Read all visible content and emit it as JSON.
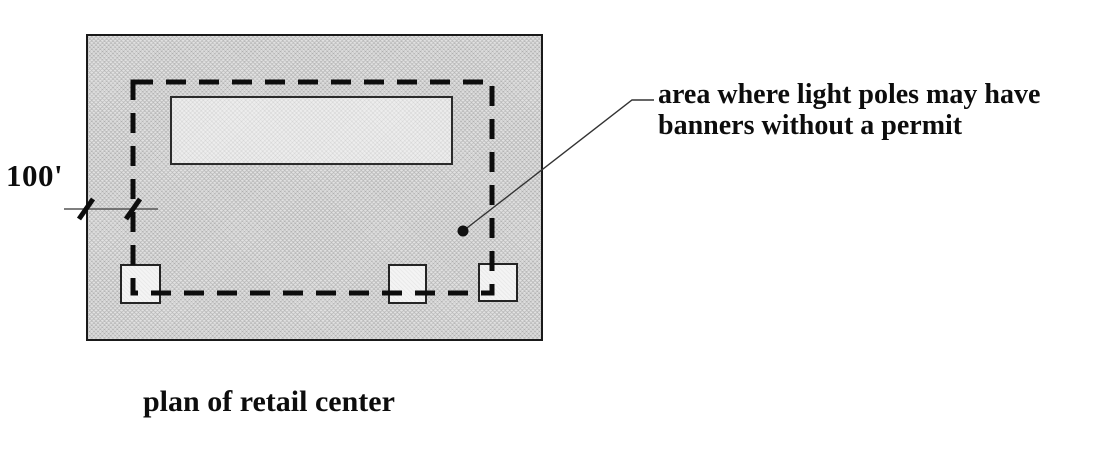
{
  "figure": {
    "caption": "plan of retail center",
    "dimension": {
      "label": "100'"
    },
    "annotation": {
      "line1": "area where light poles may have",
      "line2": "banners without a permit"
    },
    "colors": {
      "site_fill": "#d9d9d9",
      "building_fill": "#ededed",
      "pad_fill": "#f4f4f4",
      "line_color": "#111111",
      "background": "#ffffff"
    }
  }
}
